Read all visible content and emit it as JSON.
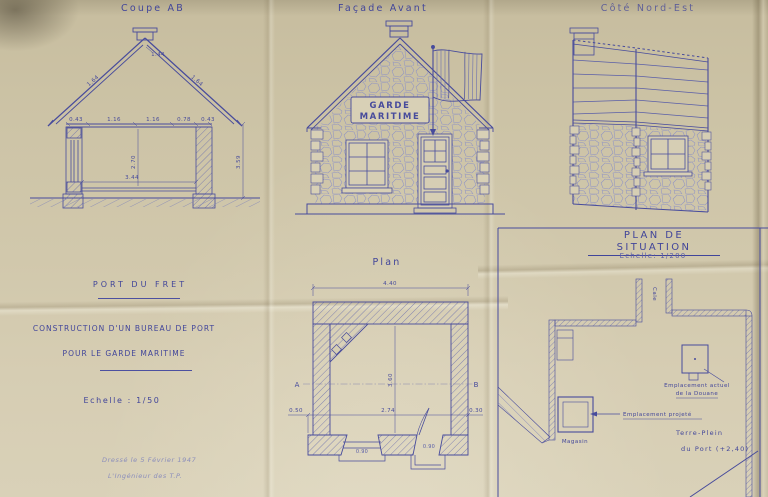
{
  "document": {
    "kind": "Scanned architectural blueprint, blue ink on aged folded paper",
    "colors": {
      "paper": "#cdc4a7",
      "paper_light": "#d9d1b8",
      "ink": "#474b9c",
      "ink_title": "#41459a",
      "ink_faint": "#8a8dbb"
    }
  },
  "views": {
    "coupe": {
      "title": "Coupe AB"
    },
    "facade": {
      "title": "Façade Avant",
      "sign_line1": "GARDE",
      "sign_line2": "MARITIME"
    },
    "cote": {
      "title": "Côté Nord-Est"
    },
    "plan": {
      "title": "Plan",
      "marker_a": "A",
      "marker_b": "B"
    },
    "situation": {
      "title": "Plan de Situation",
      "scale": "Echelle: 1/200"
    }
  },
  "cartouche": {
    "location": "Port du Fret",
    "line1": "Construction d'un Bureau de Port",
    "line2": "pour le Garde Maritime",
    "scale": "Echelle : 1/50",
    "note1": "Dressé le 5 Février 1947",
    "note2": "L'Ingénieur des T.P."
  },
  "situation_labels": {
    "cale": "Cale",
    "actuel1": "Emplacement actuel",
    "actuel2": "de la Douane",
    "projete": "Emplacement projeté",
    "terre_plein": "Terre-Plein",
    "du_port": "du Port (+2,40)",
    "magasin": "Magasin"
  },
  "dims": {
    "coupe": {
      "ridge": "1.44",
      "slope_left": "1.64",
      "slope_right": "1.64",
      "c0": "0.43",
      "c1": "1.16",
      "c2": "1.16",
      "c3": "0.78",
      "c4": "0.43",
      "interior_height": "2.70",
      "interior_width": "3.44",
      "wall_height": "3.59"
    },
    "plan": {
      "width": "4.40",
      "depth": "3.60",
      "left": "0.50",
      "inner": "2.74",
      "right": "0.30",
      "window": "0.90",
      "door": "0.90"
    }
  }
}
